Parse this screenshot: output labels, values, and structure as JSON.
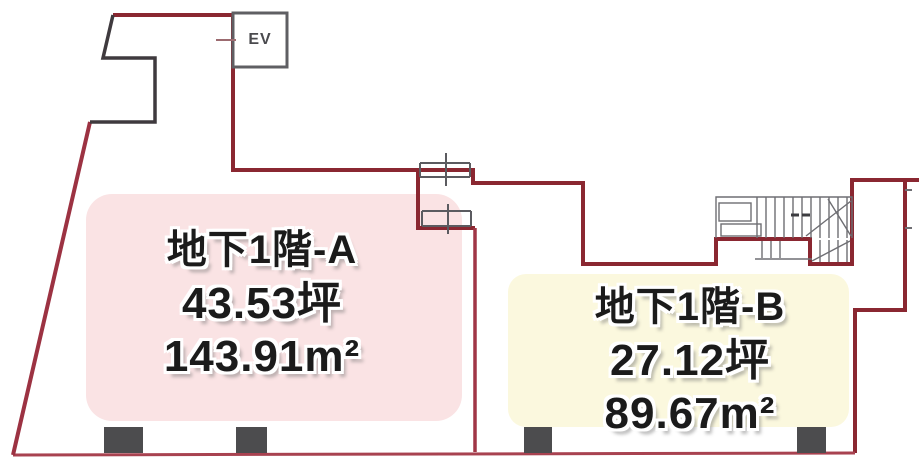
{
  "elevator": {
    "label": "EV"
  },
  "units": {
    "a": {
      "name": "地下1階-A",
      "tsubo": "43.53坪",
      "area": "143.91m²",
      "highlight_color": "#fae3e4"
    },
    "b": {
      "name": "地下1階-B",
      "tsubo": "27.12坪",
      "area": "89.67m²",
      "highlight_color": "#fbf8de"
    }
  },
  "colors": {
    "wall_red": "#8a2731",
    "wall_red_light": "#a84250",
    "divider_red": "#a03646",
    "notch_dark": "#3f3a3e",
    "fixture_gray": "#5b5b60",
    "stair_gray": "#6e6e73",
    "pillar_gray": "#4c4c4e",
    "text_ink": "#1b1b1b"
  }
}
